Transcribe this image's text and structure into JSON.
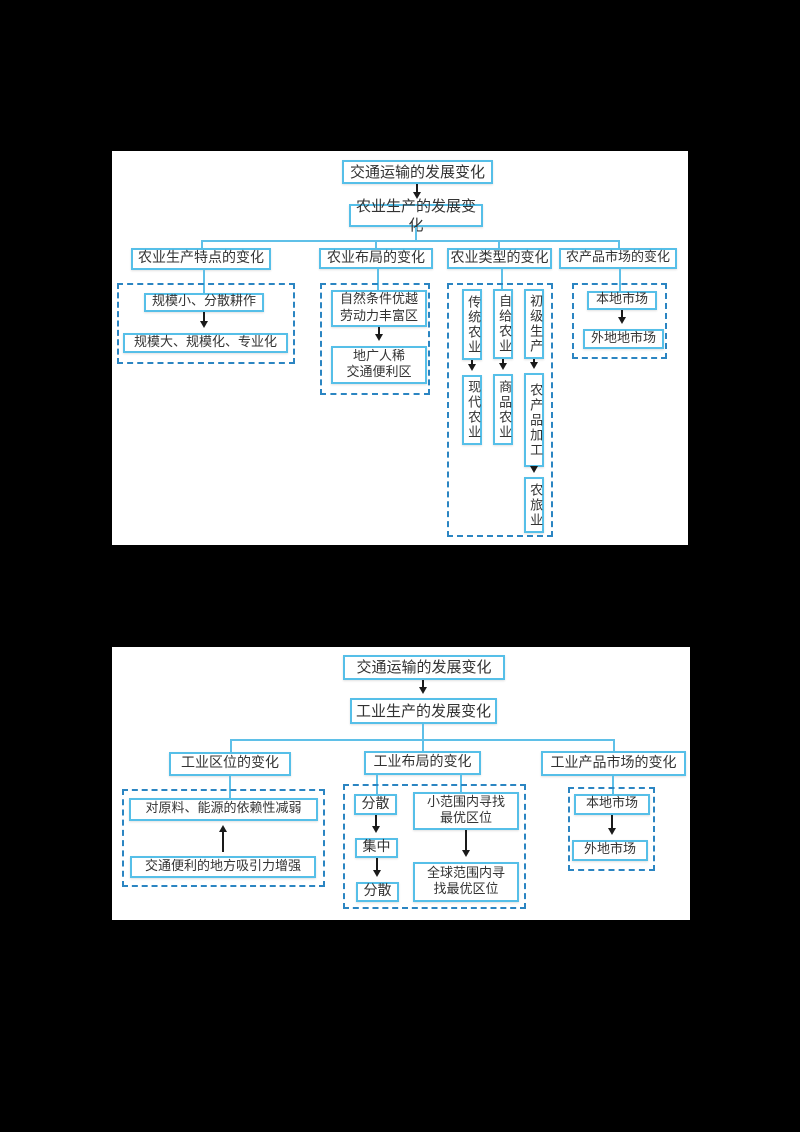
{
  "colors": {
    "page_background": "#000000",
    "panel_background": "#ffffff",
    "solid_box_border": "#56bfe8",
    "dashed_box_border": "#2b85c2",
    "connector_line": "#5fc0e8",
    "arrow": "#1a1a1a",
    "text": "#333333"
  },
  "diagram_agriculture": {
    "root": "交通运输的发展变化",
    "level2": "农业生产的发展变化",
    "branches": [
      {
        "header": "农业生产特点的变化",
        "items": [
          "规模小、分散耕作",
          "规模大、规模化、专业化"
        ]
      },
      {
        "header": "农业布局的变化",
        "items": [
          "自然条件优越\n劳动力丰富区",
          "地广人稀\n交通便利区"
        ]
      },
      {
        "header": "农业类型的变化",
        "columns": [
          [
            "传统农业",
            "现代农业"
          ],
          [
            "自给农业",
            "商品农业"
          ],
          [
            "初级生产",
            "农产品加工",
            "农旅业"
          ]
        ]
      },
      {
        "header": "农产品市场的变化",
        "items": [
          "本地市场",
          "外地地市场"
        ]
      }
    ]
  },
  "diagram_industry": {
    "root": "交通运输的发展变化",
    "level2": "工业生产的发展变化",
    "branches": [
      {
        "header": "工业区位的变化",
        "items": [
          "对原料、能源的依赖性减弱",
          "交通便利的地方吸引力增强"
        ],
        "arrow_direction": "up"
      },
      {
        "header": "工业布局的变化",
        "left_chain": [
          "分散",
          "集中",
          "分散"
        ],
        "right_chain": [
          "小范围内寻找\n最优区位",
          "全球范围内寻\n找最优区位"
        ]
      },
      {
        "header": "工业产品市场的变化",
        "items": [
          "本地市场",
          "外地市场"
        ]
      }
    ]
  }
}
